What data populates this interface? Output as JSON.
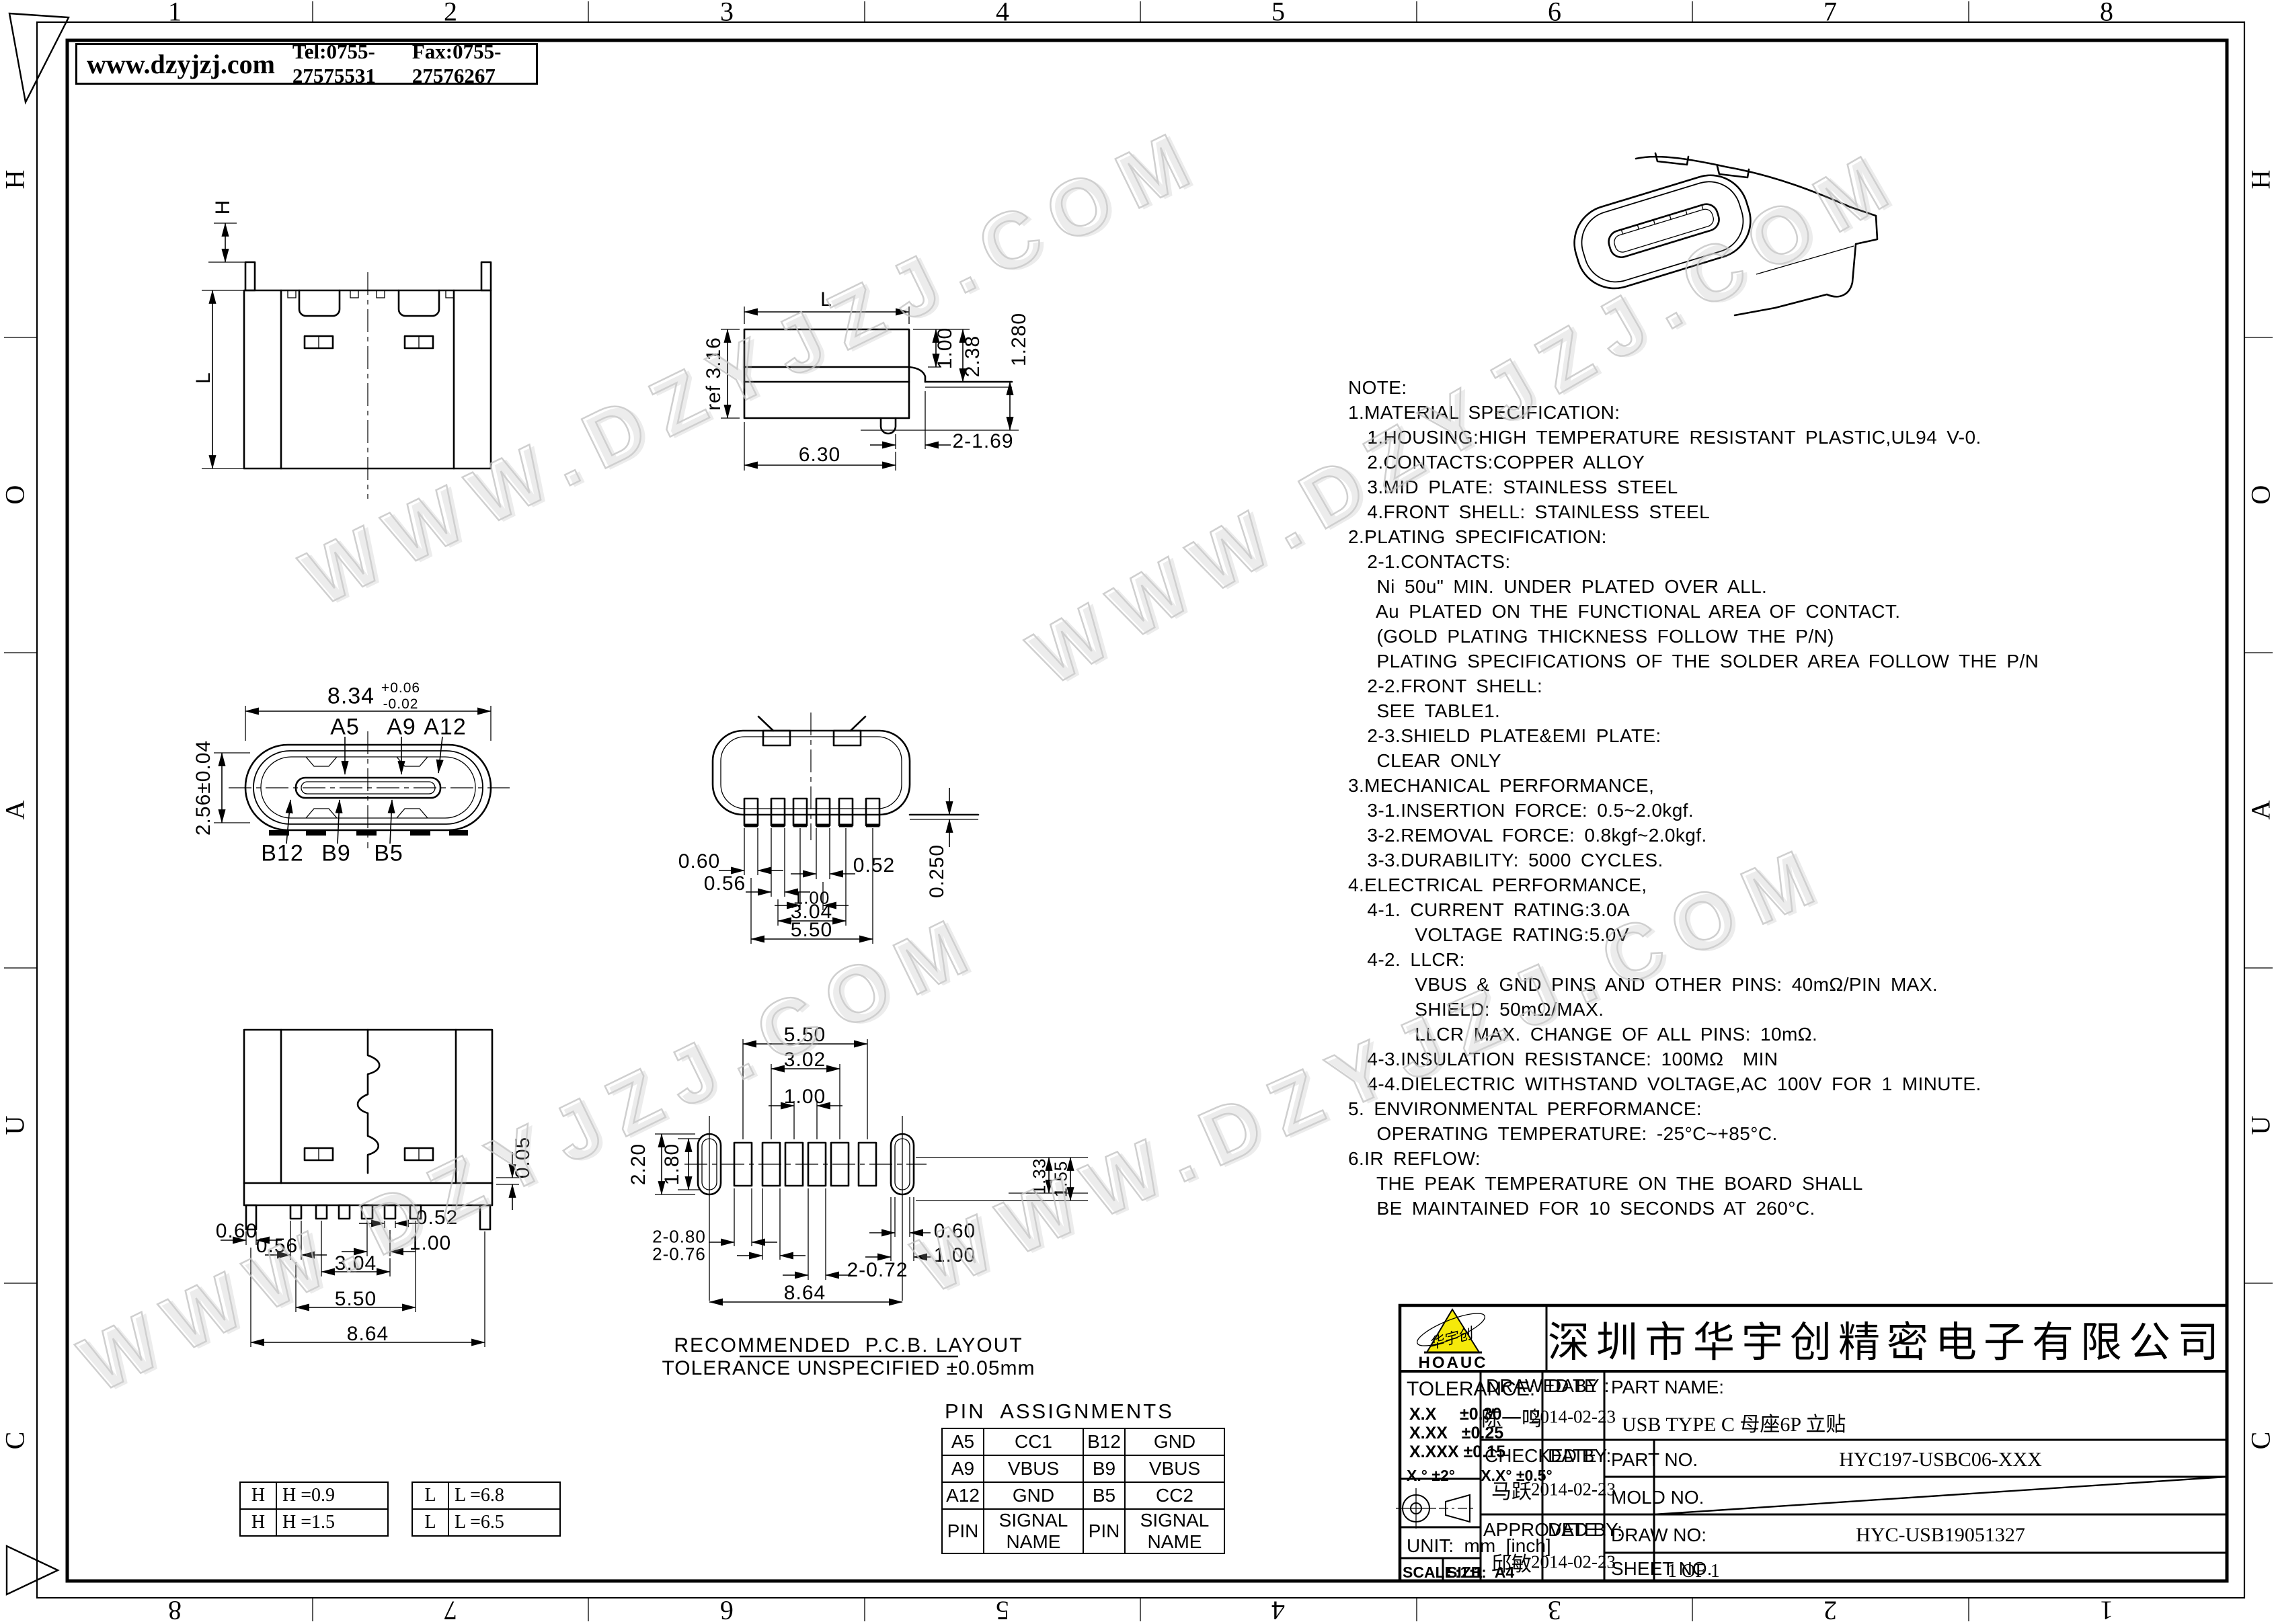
{
  "sheet": {
    "header": {
      "website": "www.dzyjzj.com",
      "tel": "Tel:0755-27575531",
      "fax": "Fax:0755-27576267"
    },
    "zones": {
      "top": [
        "1",
        "2",
        "3",
        "4",
        "5",
        "6",
        "7",
        "8"
      ],
      "bottom": [
        "8",
        "7",
        "6",
        "5",
        "4",
        "3",
        "2",
        "1"
      ],
      "left": [
        "H",
        "O",
        "A",
        "U",
        "C"
      ],
      "right": [
        "H",
        "O",
        "A",
        "U",
        "C"
      ]
    }
  },
  "watermark": "WWW.DZYJZJ.COM",
  "notes": "NOTE:\n1.MATERIAL SPECIFICATION:\n  1.HOUSING:HIGH TEMPERATURE RESISTANT PLASTIC,UL94 V-0.\n  2.CONTACTS:COPPER ALLOY\n  3.MID PLATE: STAINLESS STEEL\n  4.FRONT SHELL: STAINLESS STEEL\n2.PLATING SPECIFICATION:\n  2-1.CONTACTS:\n   Ni 50u\" MIN. UNDER PLATED OVER ALL.\n   Au PLATED ON THE FUNCTIONAL AREA OF CONTACT.\n   (GOLD PLATING THICKNESS FOLLOW THE P/N)\n   PLATING SPECIFICATIONS OF THE SOLDER AREA FOLLOW THE P/N\n  2-2.FRONT SHELL:\n   SEE TABLE1.\n  2-3.SHIELD PLATE&EMI PLATE:\n   CLEAR ONLY\n3.MECHANICAL PERFORMANCE,\n  3-1.INSERTION FORCE: 0.5~2.0kgf.\n  3-2.REMOVAL FORCE: 0.8kgf~2.0kgf.\n  3-3.DURABILITY: 5000 CYCLES.\n4.ELECTRICAL PERFORMANCE,\n  4-1. CURRENT RATING:3.0A\n       VOLTAGE RATING:5.0V\n  4-2. LLCR:\n       VBUS & GND PINS AND OTHER PINS: 40mΩ/PIN MAX.\n       SHIELD: 50mΩ/MAX.\n       LLCR MAX. CHANGE OF ALL PINS: 10mΩ.\n  4-3.INSULATION RESISTANCE: 100MΩ  MIN\n  4-4.DIELECTRIC WITHSTAND VOLTAGE,AC 100V FOR 1 MINUTE.\n5. ENVIRONMENTAL PERFORMANCE:\n   OPERATING TEMPERATURE: -25°C~+85°C.\n6.IR REFLOW:\n   THE PEAK TEMPERATURE ON THE BOARD SHALL\n   BE MAINTAINED FOR 10 SECONDS AT 260°C.",
  "views": {
    "front": {
      "dims": {
        "h": "H",
        "l": "L"
      }
    },
    "side": {
      "dims": {
        "l": "L",
        "ref316": "ref 3.16",
        "d100": "1.00",
        "d238": "2.38",
        "d1280": "1.280",
        "d2x169": "2-1.69",
        "d630": "6.30"
      }
    },
    "face": {
      "dims": {
        "w834": "8.34",
        "wtol_plus": "+0.06",
        "wtol_minus": "-0.02",
        "h256": "2.56±0.04"
      },
      "pins": {
        "a5": "A5",
        "a9": "A9",
        "a12": "A12",
        "b12": "B12",
        "b9": "B9",
        "b5": "B5"
      }
    },
    "bottom": {
      "dims": {
        "d060": "0.60",
        "d056": "0.56",
        "d052": "0.52",
        "d100": "1.00",
        "d304": "3.04",
        "d550": "5.50",
        "d0250": "0.250"
      }
    },
    "rear": {
      "dims": {
        "d005": "0.05",
        "d060": "0.60",
        "d056": "0.56",
        "d052": "0.52",
        "d100": "1.00",
        "d304": "3.04",
        "d550": "5.50",
        "d864": "8.64"
      }
    },
    "pcb": {
      "dims": {
        "d550": "5.50",
        "d302": "3.02",
        "d100a": "1.00",
        "d220": "2.20",
        "d180": "1.80",
        "d2x080": "2-0.80",
        "d2x076": "2-0.76",
        "d2x072": "2-0.72",
        "d864": "8.64",
        "d133": "1.33",
        "d155": "1.55",
        "d060": "0.60",
        "d100b": "1.00"
      }
    }
  },
  "pcb_layout": {
    "caption_title": "RECOMMENDED  P.C.B. LAYOUT",
    "caption_tol": "TOLERANCE UNSPECIFIED ±0.05mm"
  },
  "pin_assignments": {
    "title": "PIN  ASSIGNMENTS",
    "rows": [
      [
        "A5",
        "CC1",
        "B12",
        "GND"
      ],
      [
        "A9",
        "VBUS",
        "B9",
        "VBUS"
      ],
      [
        "A12",
        "GND",
        "B5",
        "CC2"
      ],
      [
        "PIN",
        "SIGNAL NAME",
        "PIN",
        "SIGNAL NAME"
      ]
    ]
  },
  "options": {
    "h": [
      [
        "H",
        "H =0.9"
      ],
      [
        "H",
        "H =1.5"
      ]
    ],
    "l": [
      [
        "L",
        "L =6.8"
      ],
      [
        "L",
        "L =6.5"
      ]
    ]
  },
  "title_block": {
    "logo": {
      "brand": "HOAUC",
      "script": "华宇创"
    },
    "company": "深圳市华宇创精密电子有限公司",
    "tolerance": {
      "label": "TOLERANCE:",
      "linear": [
        "X.X     ±0.30",
        "X.XX   ±0.25",
        "X.XXX ±0.15"
      ],
      "angular": "X.° ±2°      X.X° ±0.5°"
    },
    "unit_label": "UNIT:  mm  [inch]",
    "scale_label": "SCALE:1:1",
    "size_label": "SIZE:  A4",
    "drawn": {
      "label": "DRAWED BY :",
      "name": "陈一鸣",
      "date_label": "DATE :",
      "date": "2014-02-23"
    },
    "checked": {
      "label": "CHECKED BY:",
      "name": "马跃",
      "date_label": "DATE :",
      "date": "2014-02-23"
    },
    "approved": {
      "label": "APPROVED BY:",
      "name": "邱敏",
      "date_label": "DATE :",
      "date": "2014-02-23"
    },
    "part_name": {
      "label": "PART NAME:",
      "value": "USB TYPE C 母座6P 立贴"
    },
    "part_no": {
      "label": "PART NO.",
      "value": "HYC197-USBC06-XXX"
    },
    "mold_no": {
      "label": "MOLD NO.",
      "value": ""
    },
    "draw_no": {
      "label": "DRAW NO:",
      "value": "HYC-USB19051327"
    },
    "sheet_no": {
      "label": "SHEET NO.",
      "value": "1 OF 1"
    }
  }
}
